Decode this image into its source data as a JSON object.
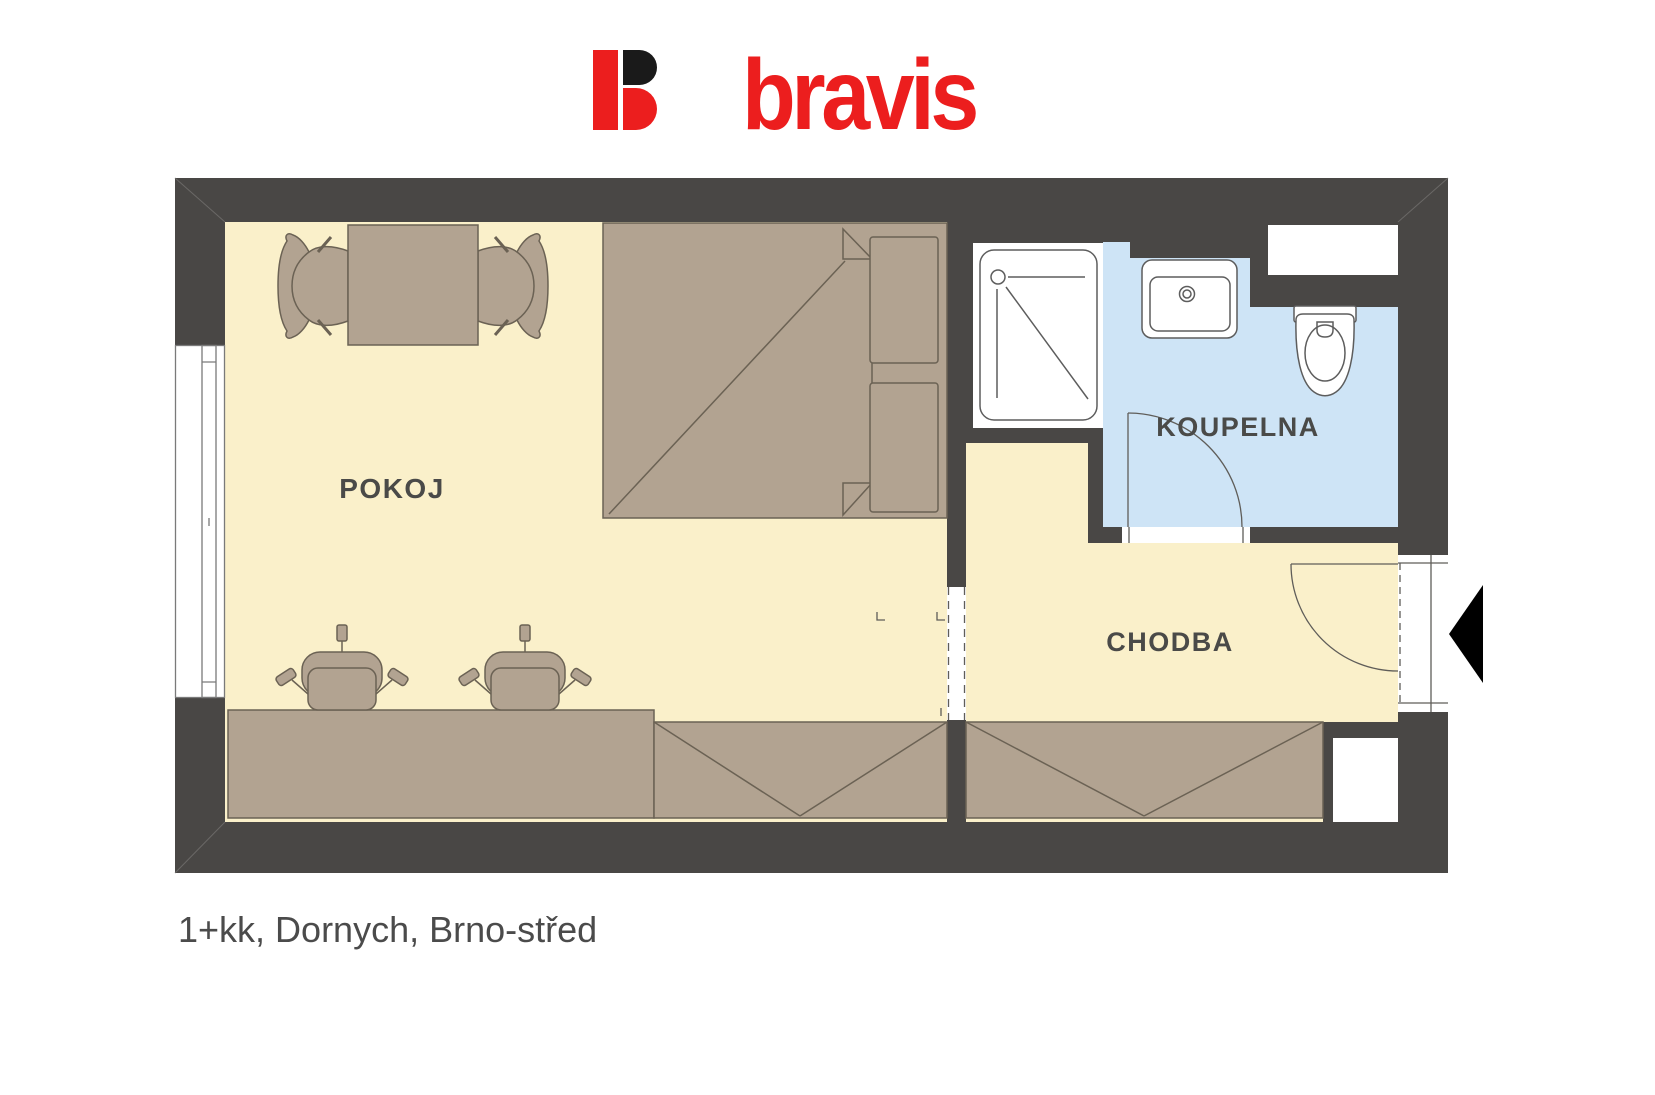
{
  "logo": {
    "text": "bravis",
    "icon": "bravis-b-icon",
    "red": "#ec1e1e",
    "black": "#1a1a1a"
  },
  "plan": {
    "labels": {
      "room": "POKOJ",
      "bathroom": "KOUPELNA",
      "hall": "CHODBA"
    },
    "colors": {
      "wall": "#494745",
      "floor_room": "#faf0ca",
      "floor_bath": "#cee4f6",
      "floor_shower": "#ffffff",
      "furniture": "#b2a391",
      "furniture_line": "#6b6254",
      "fixture_line": "#5d5d5d",
      "frame_line": "#7a7a7a",
      "label": "#4a4a48",
      "entry_arrow": "#000000"
    }
  },
  "caption": {
    "text": "1+kk, Dornych, Brno-střed"
  }
}
